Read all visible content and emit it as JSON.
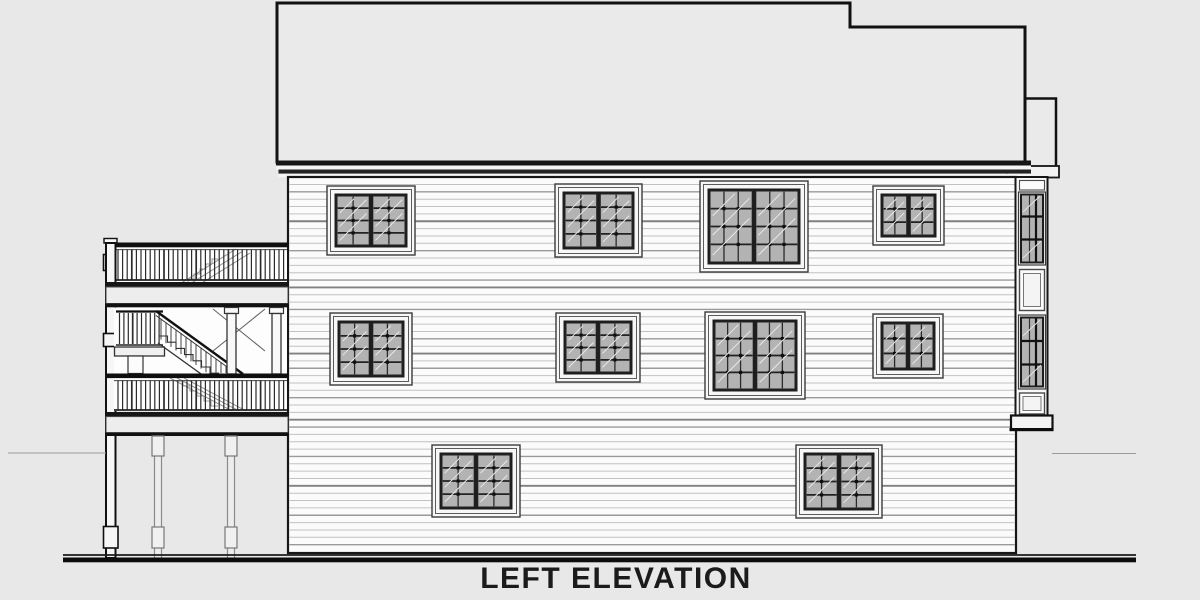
{
  "title": {
    "label": "LEFT ELEVATION"
  },
  "drawing": {
    "kind": "architectural-elevation",
    "colors": {
      "background": "#e8e8e8",
      "ink": "#161616",
      "roof_fill": "#eaeaea",
      "wall_fill": "#fbfbfb",
      "glass": "#b3b3b3",
      "trim": "#f7f7f7",
      "siding_light": "#c2c2c2",
      "siding_mid": "#9a9a9a",
      "siding_dark": "#808080",
      "ground": "#0d0d0d"
    },
    "wall": {
      "x": 288,
      "y": 177,
      "w": 728,
      "h": 376,
      "siding_spacing": 7.35
    },
    "windows": [
      {
        "x": 327,
        "y": 186,
        "w": 88,
        "h": 69,
        "cols": 2,
        "rows": 4
      },
      {
        "x": 555,
        "y": 184,
        "w": 87,
        "h": 73,
        "cols": 2,
        "rows": 4
      },
      {
        "x": 700,
        "y": 181,
        "w": 108,
        "h": 91,
        "cols": 3,
        "rows": 4
      },
      {
        "x": 873,
        "y": 186,
        "w": 71,
        "h": 59,
        "cols": 2,
        "rows": 3
      },
      {
        "x": 330,
        "y": 313,
        "w": 82,
        "h": 72,
        "cols": 2,
        "rows": 4
      },
      {
        "x": 556,
        "y": 313,
        "w": 84,
        "h": 69,
        "cols": 2,
        "rows": 4
      },
      {
        "x": 705,
        "y": 312,
        "w": 100,
        "h": 87,
        "cols": 3,
        "rows": 4
      },
      {
        "x": 873,
        "y": 314,
        "w": 70,
        "h": 64,
        "cols": 2,
        "rows": 3
      },
      {
        "x": 432,
        "y": 445,
        "w": 88,
        "h": 72,
        "cols": 2,
        "rows": 4
      },
      {
        "x": 796,
        "y": 445,
        "w": 86,
        "h": 73,
        "cols": 2,
        "rows": 4
      }
    ]
  }
}
